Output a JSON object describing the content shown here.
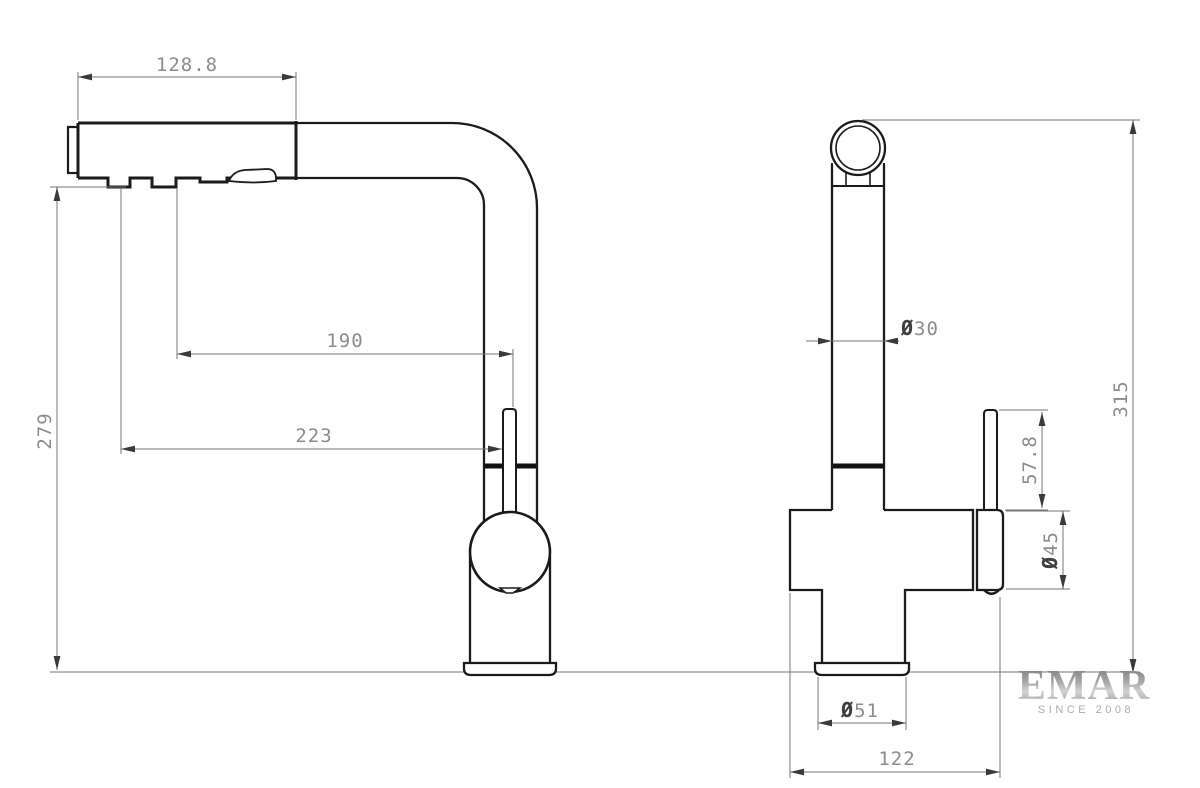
{
  "document_type": "faucet technical drawing, two orthographic views",
  "views": {
    "side_view": {
      "dimensions": {
        "head_length": "128.8",
        "spout_reach_upper": "190",
        "spout_reach_lower": "223",
        "overall_height": "279"
      }
    },
    "front_view": {
      "dimensions": {
        "tube_diameter": {
          "symbol": "Ø",
          "value": "30"
        },
        "overall_height": "315",
        "lever_height": "57.8",
        "handle_base_diameter": {
          "symbol": "Ø",
          "value": "45"
        },
        "base_diameter": {
          "symbol": "Ø",
          "value": "51"
        },
        "body_depth": "122"
      }
    }
  },
  "logo": {
    "brand": "EMAR",
    "tagline": "SINCE 2008"
  },
  "colors": {
    "background": "#ffffff",
    "object_line": "#1b1b1b",
    "dimension_line": "#757575",
    "dimension_text": "#8c8c8c",
    "diameter_symbol": "#3f3f3f",
    "logo_silver_dark": "#7d7d7d",
    "logo_silver_light": "#d2d2d2",
    "logo_tagline": "#ababab"
  }
}
